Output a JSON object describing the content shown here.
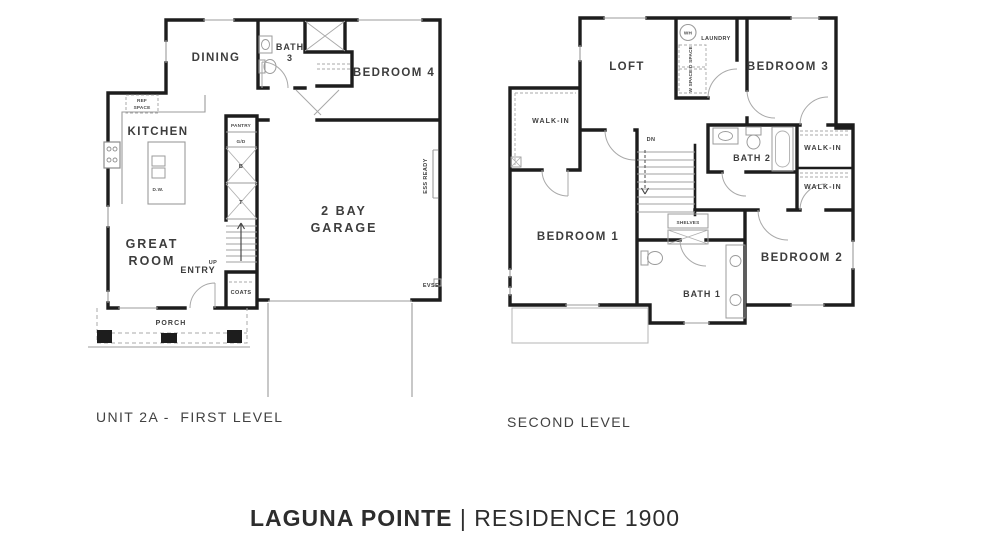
{
  "colors": {
    "wall": "#1d1d1d",
    "fixture_line": "#9b9b9b",
    "dashed_line": "#a8a8a8",
    "label": "#3d3d3d",
    "background": "#ffffff"
  },
  "captions": {
    "first_level": "UNIT 2A -  FIRST LEVEL",
    "second_level": "SECOND LEVEL"
  },
  "title": {
    "name": "LAGUNA POINTE",
    "divider": " | ",
    "residence": "RESIDENCE 1900"
  },
  "first_level": {
    "dining": "DINING",
    "bath3_line1": "BATH",
    "bath3_line2": "3",
    "bedroom4": "BEDROOM 4",
    "kitchen": "KITCHEN",
    "ref_space_line1": "REF",
    "ref_space_line2": "SPACE",
    "pantry": "PANTRY",
    "garbage_disposal": "G/D",
    "cabinet_b": "B",
    "cabinet_t": "T",
    "dishwasher": "D.W.",
    "garage_line1": "2 BAY",
    "garage_line2": "GARAGE",
    "great_room_line1": "GREAT",
    "great_room_line2": "ROOM",
    "entry": "ENTRY",
    "up": "UP",
    "coats": "COATS",
    "porch": "PORCH",
    "evse": "EVSE",
    "ess_ready": "ESS READY"
  },
  "second_level": {
    "loft": "LOFT",
    "water_heater": "WH",
    "laundry": "LAUNDRY",
    "dryer_space": "D SPACE",
    "washer_space": "W SPACE",
    "bedroom3": "BEDROOM 3",
    "walk_in_left": "WALK-IN",
    "down": "DN",
    "bath2": "BATH 2",
    "walk_in_upper": "WALK-IN",
    "walk_in_lower": "WALK-IN",
    "bedroom1": "BEDROOM 1",
    "shelves": "SHELVES",
    "bedroom2": "BEDROOM 2",
    "bath1": "BATH 1"
  }
}
